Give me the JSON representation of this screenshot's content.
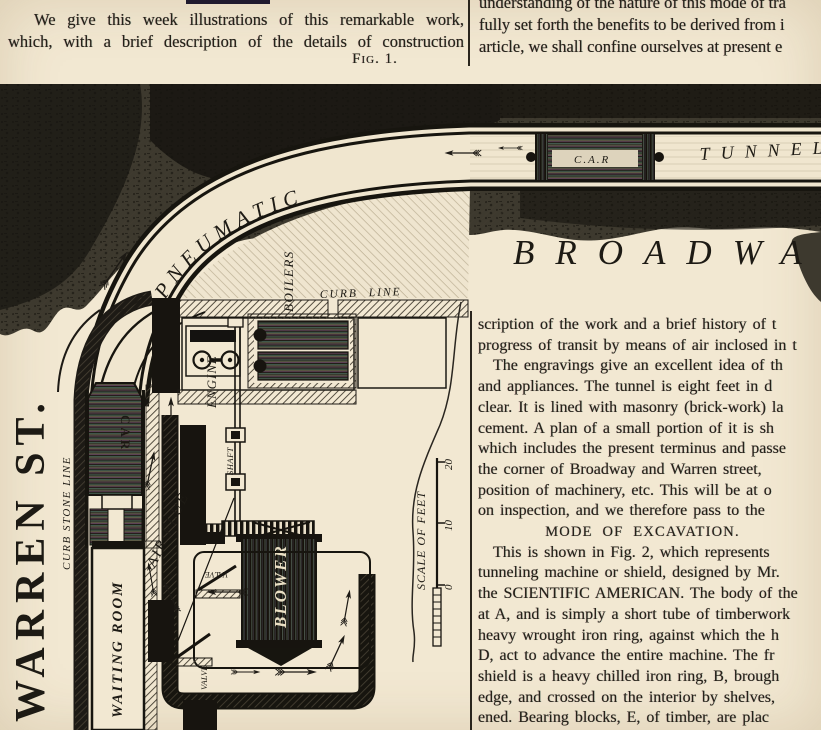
{
  "intro_left": {
    "line1": "We give this week illustrations of this remarkable work,",
    "line2": "which, with a brief description of the details of construction",
    "fig_caption": "Fig. 1."
  },
  "intro_right": {
    "line1": "understanding of the nature of this mode of tra",
    "line2": "fully set forth the benefits to be derived from i",
    "line3": "article, we shall confine ourselves at present e"
  },
  "article_column": {
    "lines": [
      "scription of the work and a brief history of t",
      "progress of transit by means of air inclosed in t",
      "The engravings give an excellent idea of th",
      "and appliances.  The tunnel is eight feet in d",
      "clear.  It is lined with masonry (brick-work) la",
      "cement.  A plan of a small portion of it is sh",
      "which includes the present terminus and passe",
      "the corner of Broadway and Warren street,",
      "position of machinery, etc.  This will be at o",
      "on inspection, and we therefore pass to the",
      "MODE OF EXCAVATION.",
      "This is shown in Fig. 2, which represents",
      "tunneling machine or shield, designed by Mr.",
      "the SCIENTIFIC AMERICAN.  The body of the",
      "at A, and is simply a short tube of timberwork",
      "heavy wrought iron ring, against which the h",
      "D, act to advance the entire machine.  The fr",
      "shield is a heavy chilled iron ring, B, brough",
      "edge, and crossed on the interior by shelves,",
      "ened.  Bearing blocks, E, of timber, are plac",
      "masonry, as shown, on which the rams pr"
    ]
  },
  "figure": {
    "labels": {
      "pneumatic": "PNEUMATIC",
      "tunnel": "TUNNEL",
      "tunnel_car": "C.A.R",
      "broadway": "BROADWAY",
      "warren_st": "WARREN ST.",
      "curb_stone_line": "CURB STONE LINE",
      "curb_line": "CURB LINE",
      "station_car": "CAR",
      "engine": "ENGINE",
      "boilers": "BOILERS",
      "shaft": "SHAFT",
      "blower": "BLOWER",
      "valve_upper": "VALVE",
      "valve_lower": "VALVE",
      "air_flue": "AIR FLUE",
      "waiting_room": "WAITING ROOM",
      "scale_label": "SCALE OF FEET"
    },
    "scale_ticks": [
      "20",
      "10",
      "0"
    ]
  }
}
